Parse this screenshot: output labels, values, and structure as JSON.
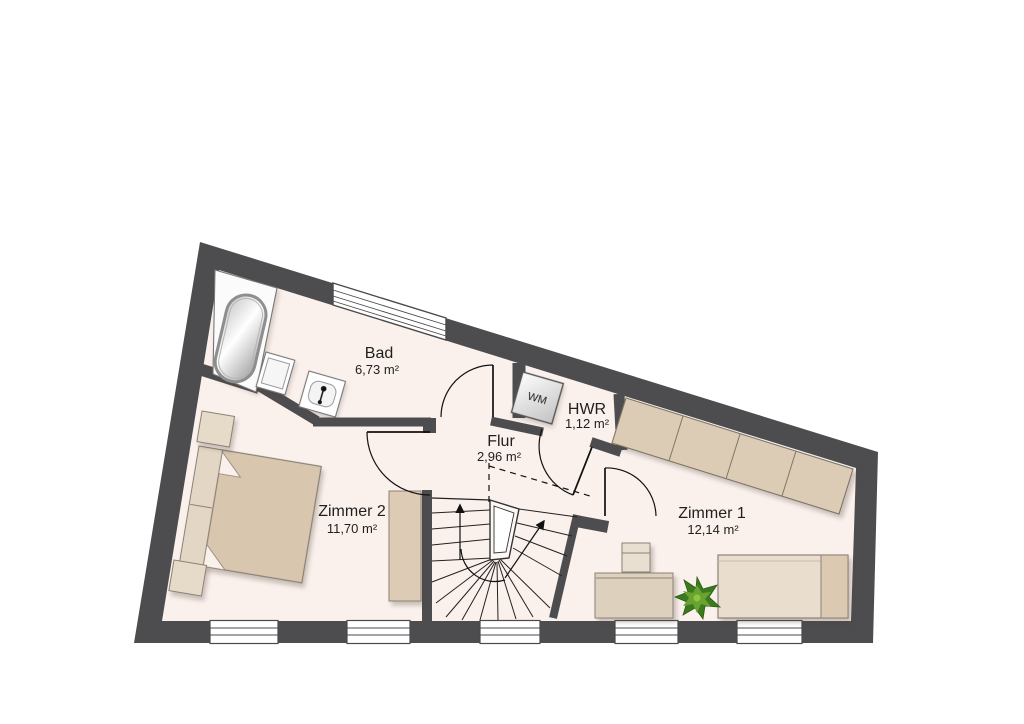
{
  "plan_title": "Obergeschoss Grundriss",
  "colors": {
    "wall": "#4d4d4f",
    "floor": "#faf0ec",
    "outside": "#ffffff",
    "furniture": "#dbc9b2",
    "furniture_light": "#e9ddcd",
    "furniture_dark": "#d8c6ae",
    "outline": "#8a8276",
    "line": "#1a1a1a",
    "plant_dark": "#3c7a1f",
    "plant_light": "#6aa332"
  },
  "rooms": {
    "bad": {
      "name": "Bad",
      "area": "6,73 m²"
    },
    "flur": {
      "name": "Flur",
      "area": "2,96 m²"
    },
    "hwr": {
      "name": "HWR",
      "area": "1,12 m²"
    },
    "zimmer1": {
      "name": "Zimmer 1",
      "area": "12,14 m²"
    },
    "zimmer2": {
      "name": "Zimmer 2",
      "area": "11,70 m²"
    }
  },
  "appliances": {
    "washing_machine": "WM"
  }
}
